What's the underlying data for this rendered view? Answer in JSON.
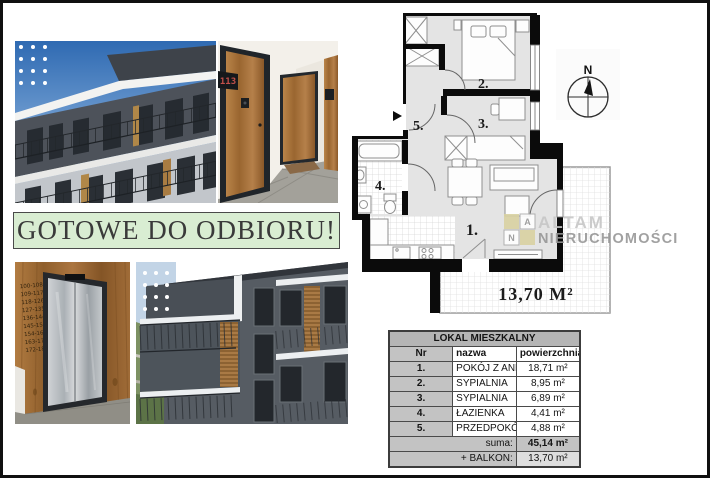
{
  "banner": {
    "text": "GOTOWE DO ODBIORU!"
  },
  "photos": {
    "door_number": "113",
    "elevator_floor_ranges": [
      "100-108",
      "109-117",
      "118-126",
      "127-135",
      "136-144",
      "145-153",
      "154-162",
      "163-171",
      "172-180"
    ]
  },
  "floor_plan": {
    "room_labels": {
      "r1": "1.",
      "r2": "2.",
      "r3": "3.",
      "r4": "4.",
      "r5": "5."
    },
    "balcony_area": "13,70 M²",
    "compass": {
      "label": "N"
    }
  },
  "watermark": {
    "tile_a": "A",
    "tile_n": "N",
    "brand_top": "ALTAM",
    "brand_bottom": "NIERUCHOMOŚCI",
    "beige": "#d9d2a2"
  },
  "table": {
    "title": "LOKAL MIESZKALNY",
    "columns": {
      "nr": "Nr",
      "name": "nazwa",
      "area": "powierzchnia"
    },
    "rows": [
      {
        "nr": "1.",
        "name": "POKÓJ Z ANEKSEM",
        "area": "18,71 m²"
      },
      {
        "nr": "2.",
        "name": "SYPIALNIA",
        "area": "8,95 m²"
      },
      {
        "nr": "3.",
        "name": "SYPIALNIA",
        "area": "6,89 m²"
      },
      {
        "nr": "4.",
        "name": "ŁAZIENKA",
        "area": "4,41 m²"
      },
      {
        "nr": "5.",
        "name": "PRZEDPOKÓJ",
        "area": "4,88 m²"
      }
    ],
    "sum_label": "suma:",
    "sum_value": "45,14 m²",
    "balcony_label": "+ BALKON:",
    "balcony_value": "13,70 m²"
  }
}
